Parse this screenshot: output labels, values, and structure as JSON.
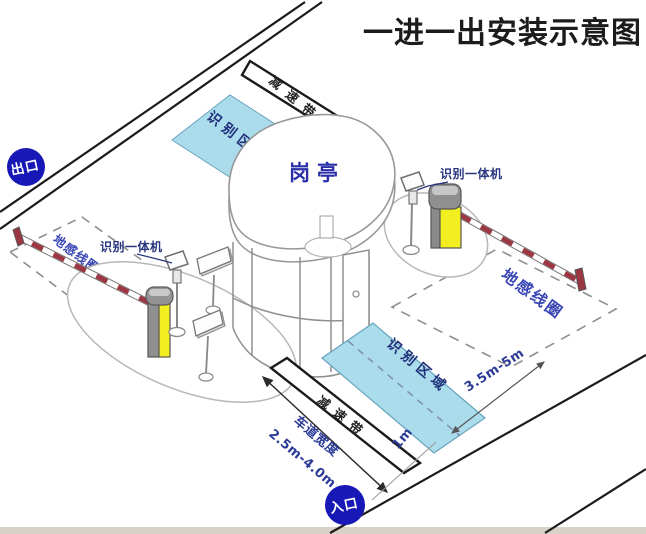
{
  "title": "一进一出安装示意图",
  "badges": {
    "exit": "出口",
    "entrance": "入口"
  },
  "booth": {
    "label": "岗亭"
  },
  "exit_lane": {
    "speed_bump": "减速带",
    "recognition_area": "识别区域",
    "ground_coil": "地感线圈",
    "camera_label": "识别一体机"
  },
  "entry_lane": {
    "speed_bump": "减速带",
    "recognition_area": "识别区域",
    "ground_coil": "地感线圈",
    "camera_label": "识别一体机",
    "lane_width_label": "车道宽度",
    "lane_width_value": "2.5m-4.0m",
    "coil_distance": "3.5m-5m",
    "stop_line_offset": "1m"
  },
  "colors": {
    "badge_blue": "#1718b5",
    "recognition_area_fill": "#abdcec",
    "machine_yellow": "#f2ee20",
    "arm_stripe_red": "#9c3642",
    "label_blue": "#2a3a96"
  }
}
